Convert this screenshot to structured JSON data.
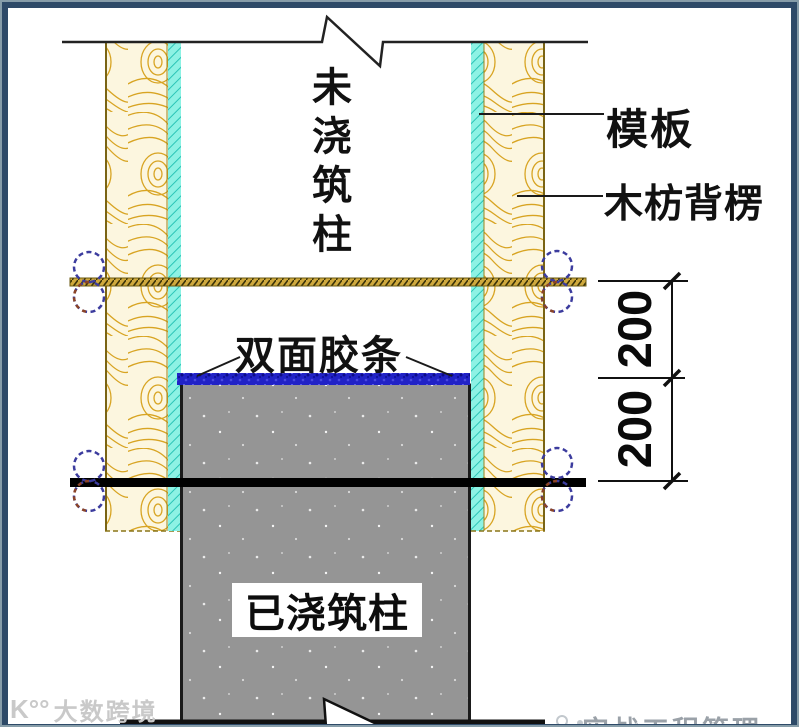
{
  "diagram": {
    "vertical_title": "未浇筑柱",
    "callouts": {
      "formwork": "模板",
      "wood_batten": "木枋背楞",
      "double_sided_tape": "双面胶条"
    },
    "poured_column_label": "已浇筑柱",
    "dimensions": {
      "upper": "200",
      "lower": "200"
    },
    "colors": {
      "frame_border": "#2E4A68",
      "wood_fill": "#FCF6DF",
      "wood_grain": "#D8A422",
      "formwork_cyan": "#8DF2E4",
      "tape_blue": "#2122C6",
      "concrete_gray": "#959595",
      "tie_rod_olive": "#CFA93D"
    }
  },
  "watermark": {
    "logo": "K°°",
    "text": "大数跨境"
  },
  "footer": {
    "icon": "brand-dots-icon",
    "brand_text": "实战工程管理"
  }
}
